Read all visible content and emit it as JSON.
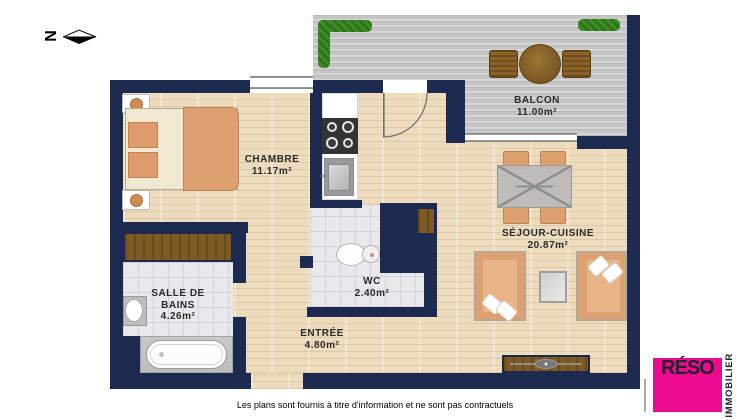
{
  "compass": {
    "label": "N"
  },
  "plan": {
    "rooms": {
      "chambre": {
        "name": "CHAMBRE",
        "area": "11.17m²"
      },
      "balcon": {
        "name": "BALCON",
        "area": "11.00m²"
      },
      "sejour_cuisine": {
        "name": "SÉJOUR-CUISINE",
        "area": "20.87m²"
      },
      "salle_de_bains": {
        "name_line1": "SALLE DE",
        "name_line2": "BAINS",
        "area": "4.26m²"
      },
      "wc": {
        "name": "WC",
        "area": "2.40m²"
      },
      "entree": {
        "name": "ENTRÉE",
        "area": "4.80m²"
      }
    }
  },
  "footer": {
    "disclaimer": "Les plans sont fournis à titre d'information et ne sont pas contractuels"
  },
  "logo": {
    "brand": "RÉSO",
    "tagline": "IMMOBILIER"
  },
  "colors": {
    "wall_navy": "#1b2a4e",
    "floor_wood": "#ecdcbd",
    "balcony_deck": "#cbcbcb",
    "tile": "#e9e9ec",
    "furniture_orange": "#dfa071",
    "wood_brown": "#7d5b22",
    "hedge_green": "#3f8d26",
    "logo_magenta": "#ec0a8e"
  }
}
